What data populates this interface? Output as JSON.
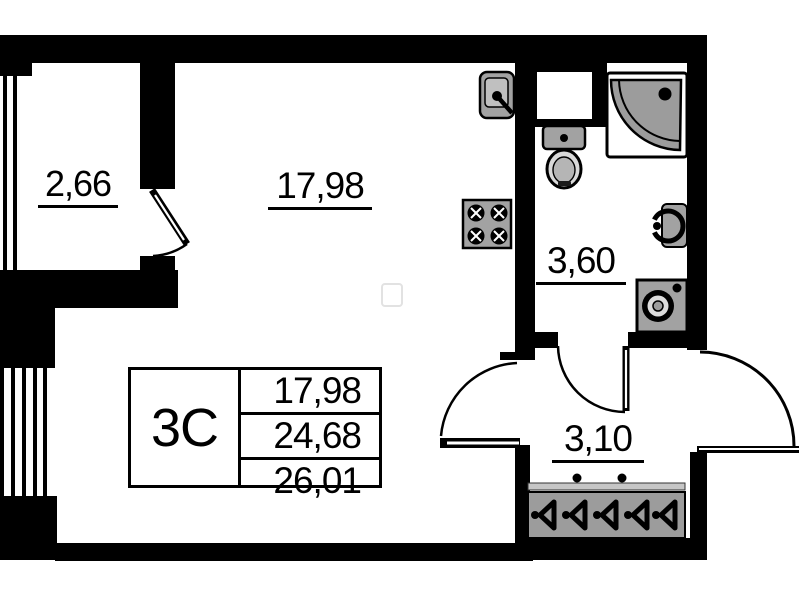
{
  "title": "apartment-floor-plan",
  "room_labels": [
    {
      "id": "balcony",
      "area": "2,66"
    },
    {
      "id": "living",
      "area": "17,98"
    },
    {
      "id": "bathroom",
      "area": "3,60"
    },
    {
      "id": "hallway",
      "area": "3,10"
    }
  ],
  "info_table": {
    "unit_type": "3С",
    "rows": [
      "17,98",
      "24,68",
      "26,01"
    ]
  },
  "fixtures": [
    "kitchen-sink",
    "cooktop",
    "ventilation-shaft",
    "toilet",
    "shower-cabin",
    "wash-basin",
    "washing-machine",
    "wardrobe-hangers"
  ],
  "colors": {
    "wall": "#000000",
    "fixture": "#a2a2a2",
    "background": "#ffffff"
  }
}
